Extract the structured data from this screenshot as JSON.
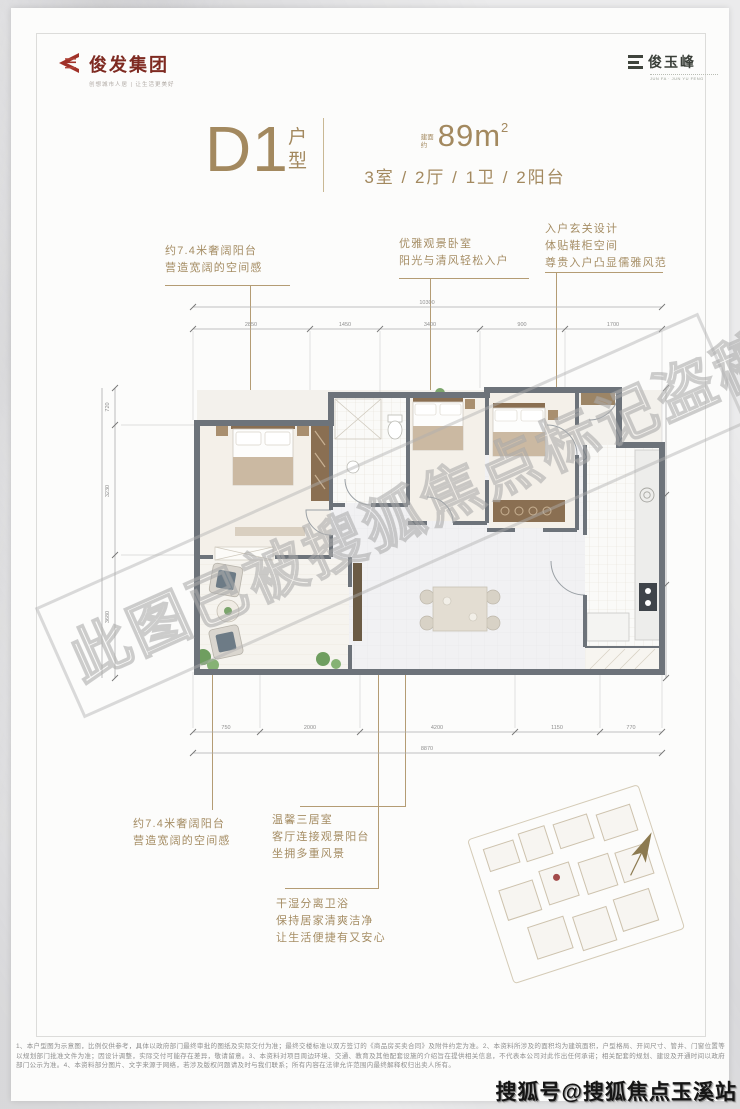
{
  "brand_left": {
    "name": "俊发集团",
    "tagline": "创想城市人居 | 让生活更美好"
  },
  "brand_right": {
    "name": "俊玉峰",
    "tagline": "JUN FA · JUN YU FENG"
  },
  "unit": {
    "code": "D1",
    "code_suffix": "户型",
    "area_prefix": "建面约",
    "area_value": "89m",
    "area_sup": "2",
    "layout": "3室 / 2厅 / 1卫 / 2阳台"
  },
  "callouts": {
    "top_left": [
      "约7.4米奢阔阳台",
      "营造宽阔的空间感"
    ],
    "top_mid": [
      "优雅观景卧室",
      "阳光与清风轻松入户"
    ],
    "top_right": [
      "入户玄关设计",
      "体贴鞋柜空间",
      "尊贵入户凸显儒雅风范"
    ],
    "bottom_left": [
      "约7.4米奢阔阳台",
      "营造宽阔的空间感"
    ],
    "bottom_mid": [
      "温馨三居室",
      "客厅连接观景阳台",
      "坐拥多重风景"
    ],
    "bottom_bath": [
      "干湿分离卫浴",
      "保持居家清爽洁净",
      "让生活便捷有又安心"
    ]
  },
  "plan": {
    "dims": {
      "top_total": "10300",
      "top": [
        "2850",
        "1450",
        "3400",
        "900",
        "1700"
      ],
      "bottom_total": "8870",
      "bottom": [
        "750",
        "2000",
        "4200",
        "1150",
        "770"
      ],
      "left": [
        "720",
        "3230",
        "3680"
      ],
      "right": [
        "2100",
        "1500",
        "2900"
      ]
    }
  },
  "watermarks": {
    "diagonal": "此图已被搜狐焦点标记盗稿",
    "sohu": "搜狐号@搜狐焦点玉溪站"
  },
  "disclaimer": "1、本户型图为示意图，比例仅供参考，具体以政府部门最终审批的图纸及实际交付为准；最终交楼标准以双方签订的《商品房买卖合同》及附件约定为准。2、本资料所涉及的面积均为建筑面积，户型格局、开间尺寸、管井、门窗位置等以规划部门批准文件为准；因设计调整，实际交付可能存在差异，敬请留意。3、本资料对项目周边环境、交通、教育及其他配套设施的介绍旨在提供相关信息，不代表本公司对此作出任何承诺；相关配套的规划、建设及开通时间以政府部门公示为准。4、本资料部分图片、文字来源于网络，若涉及版权问题请及时与我们联系；所有内容在法律允许范围内最终解释权归出卖人所有。",
  "colors": {
    "accent": "#a58c63",
    "brand_red": "#8f2b25",
    "wall": "#6f757a"
  }
}
